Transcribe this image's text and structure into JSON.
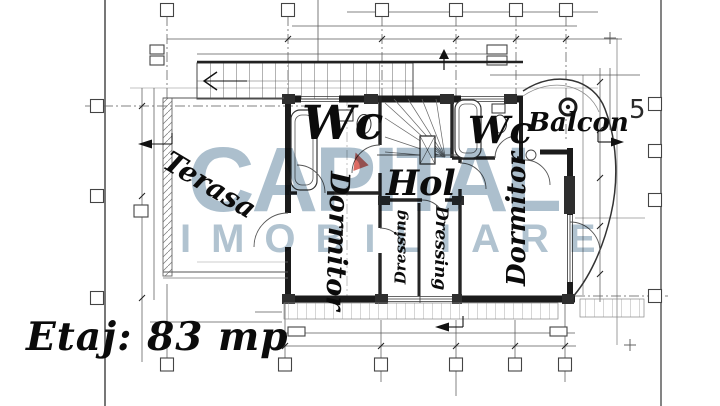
{
  "document": {
    "type": "floor-plan-drawing",
    "floor_area_label": "Etaj: 83 mp",
    "grid_axis_number": "5"
  },
  "watermark": {
    "line1": "CAPITAL",
    "line2": "IMOBILIARE",
    "text_color": "#9db4c5",
    "accent_color": "#d95b52"
  },
  "rooms": {
    "terasa": "Terasa",
    "wc_left": "Wc",
    "wc_right": "Wc",
    "balcon": "Balcon",
    "hol": "Hol",
    "dormitor_left": "Dormitor",
    "dressing_left": "Dressing",
    "dressing_right": "Dressing",
    "dormitor_right": "Dormitor"
  },
  "colors": {
    "background": "#ffffff",
    "wall": "#1b1b1b",
    "line": "#555555",
    "label": "#0b0b0b"
  }
}
